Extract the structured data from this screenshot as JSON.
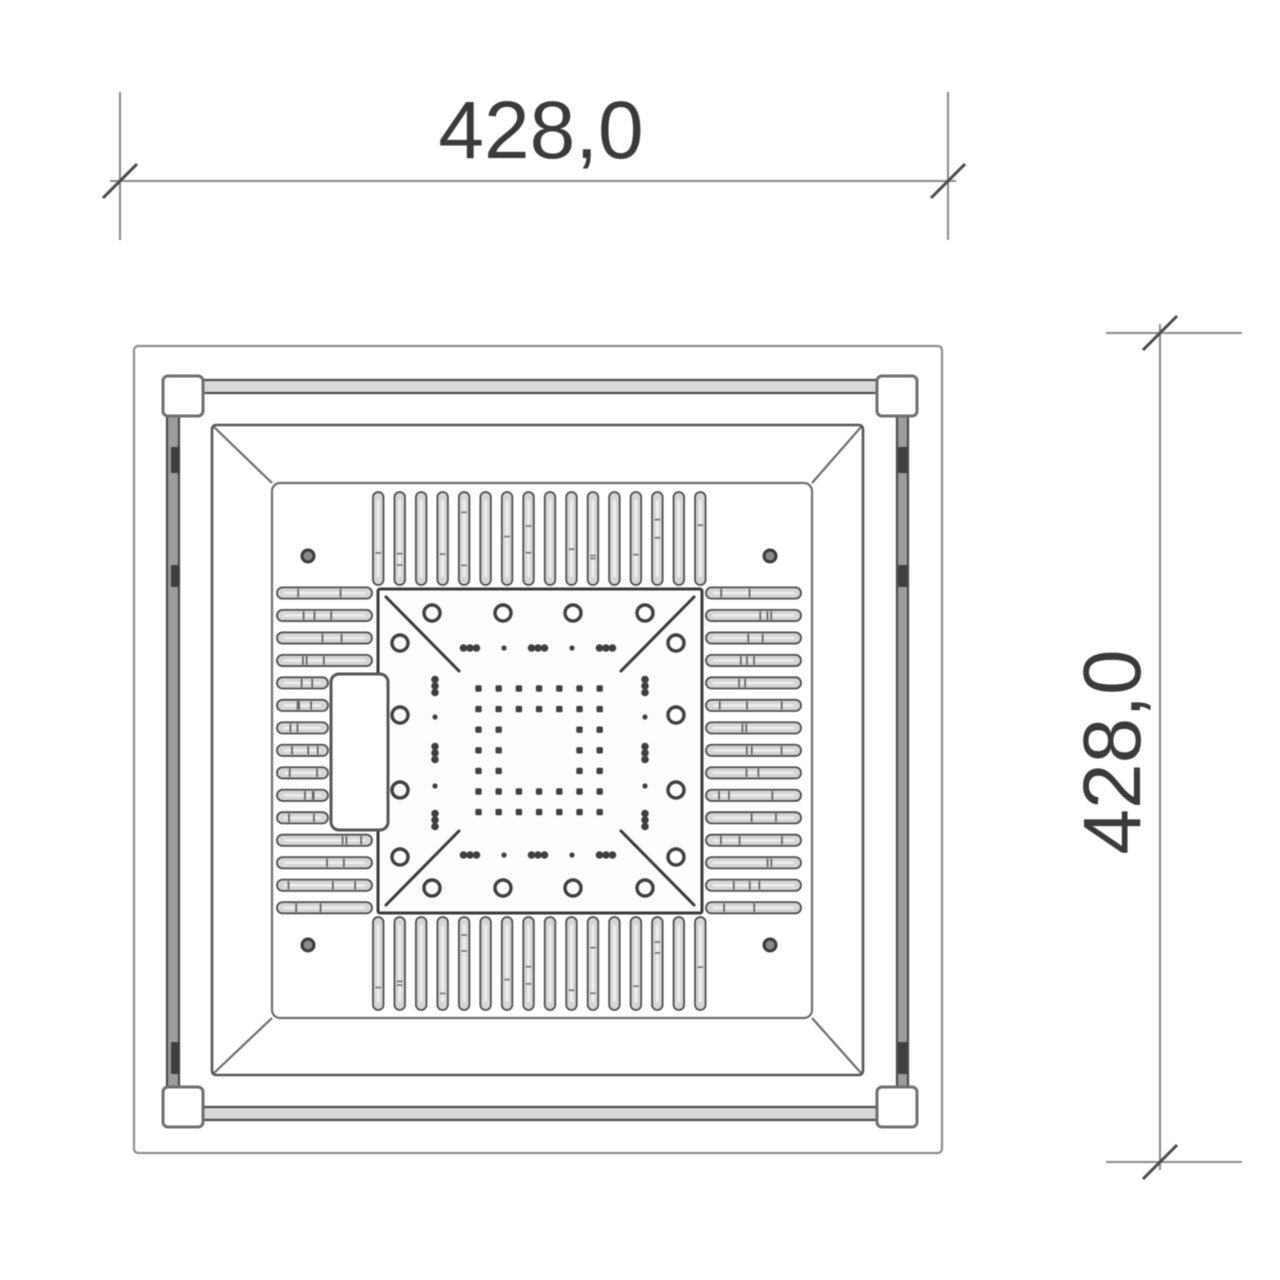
{
  "drawing": {
    "dimension_top": {
      "label": "428,0"
    },
    "dimension_right": {
      "label": "428,0"
    },
    "features": {
      "corner_bracket_count": 4,
      "top_fin_count": 16,
      "bottom_fin_count": 16,
      "left_slat_count": 15,
      "right_slat_count": 15,
      "screw_ring_count": 16,
      "panel_hole_count": 4,
      "pad_grid": "7x7 with open 3x3 center",
      "plate_diagonal_count": 4,
      "connector_block_count": 1
    },
    "colors": {
      "ink_dark": "#3a3a3a",
      "ink_mid": "#4e4e4e",
      "ink_soft": "#6e6e6e",
      "ink_light": "#8e8e8e",
      "fill_metal": "#d6d6d6",
      "fill_rail": "#d9d9d9",
      "background": "#ffffff"
    }
  }
}
